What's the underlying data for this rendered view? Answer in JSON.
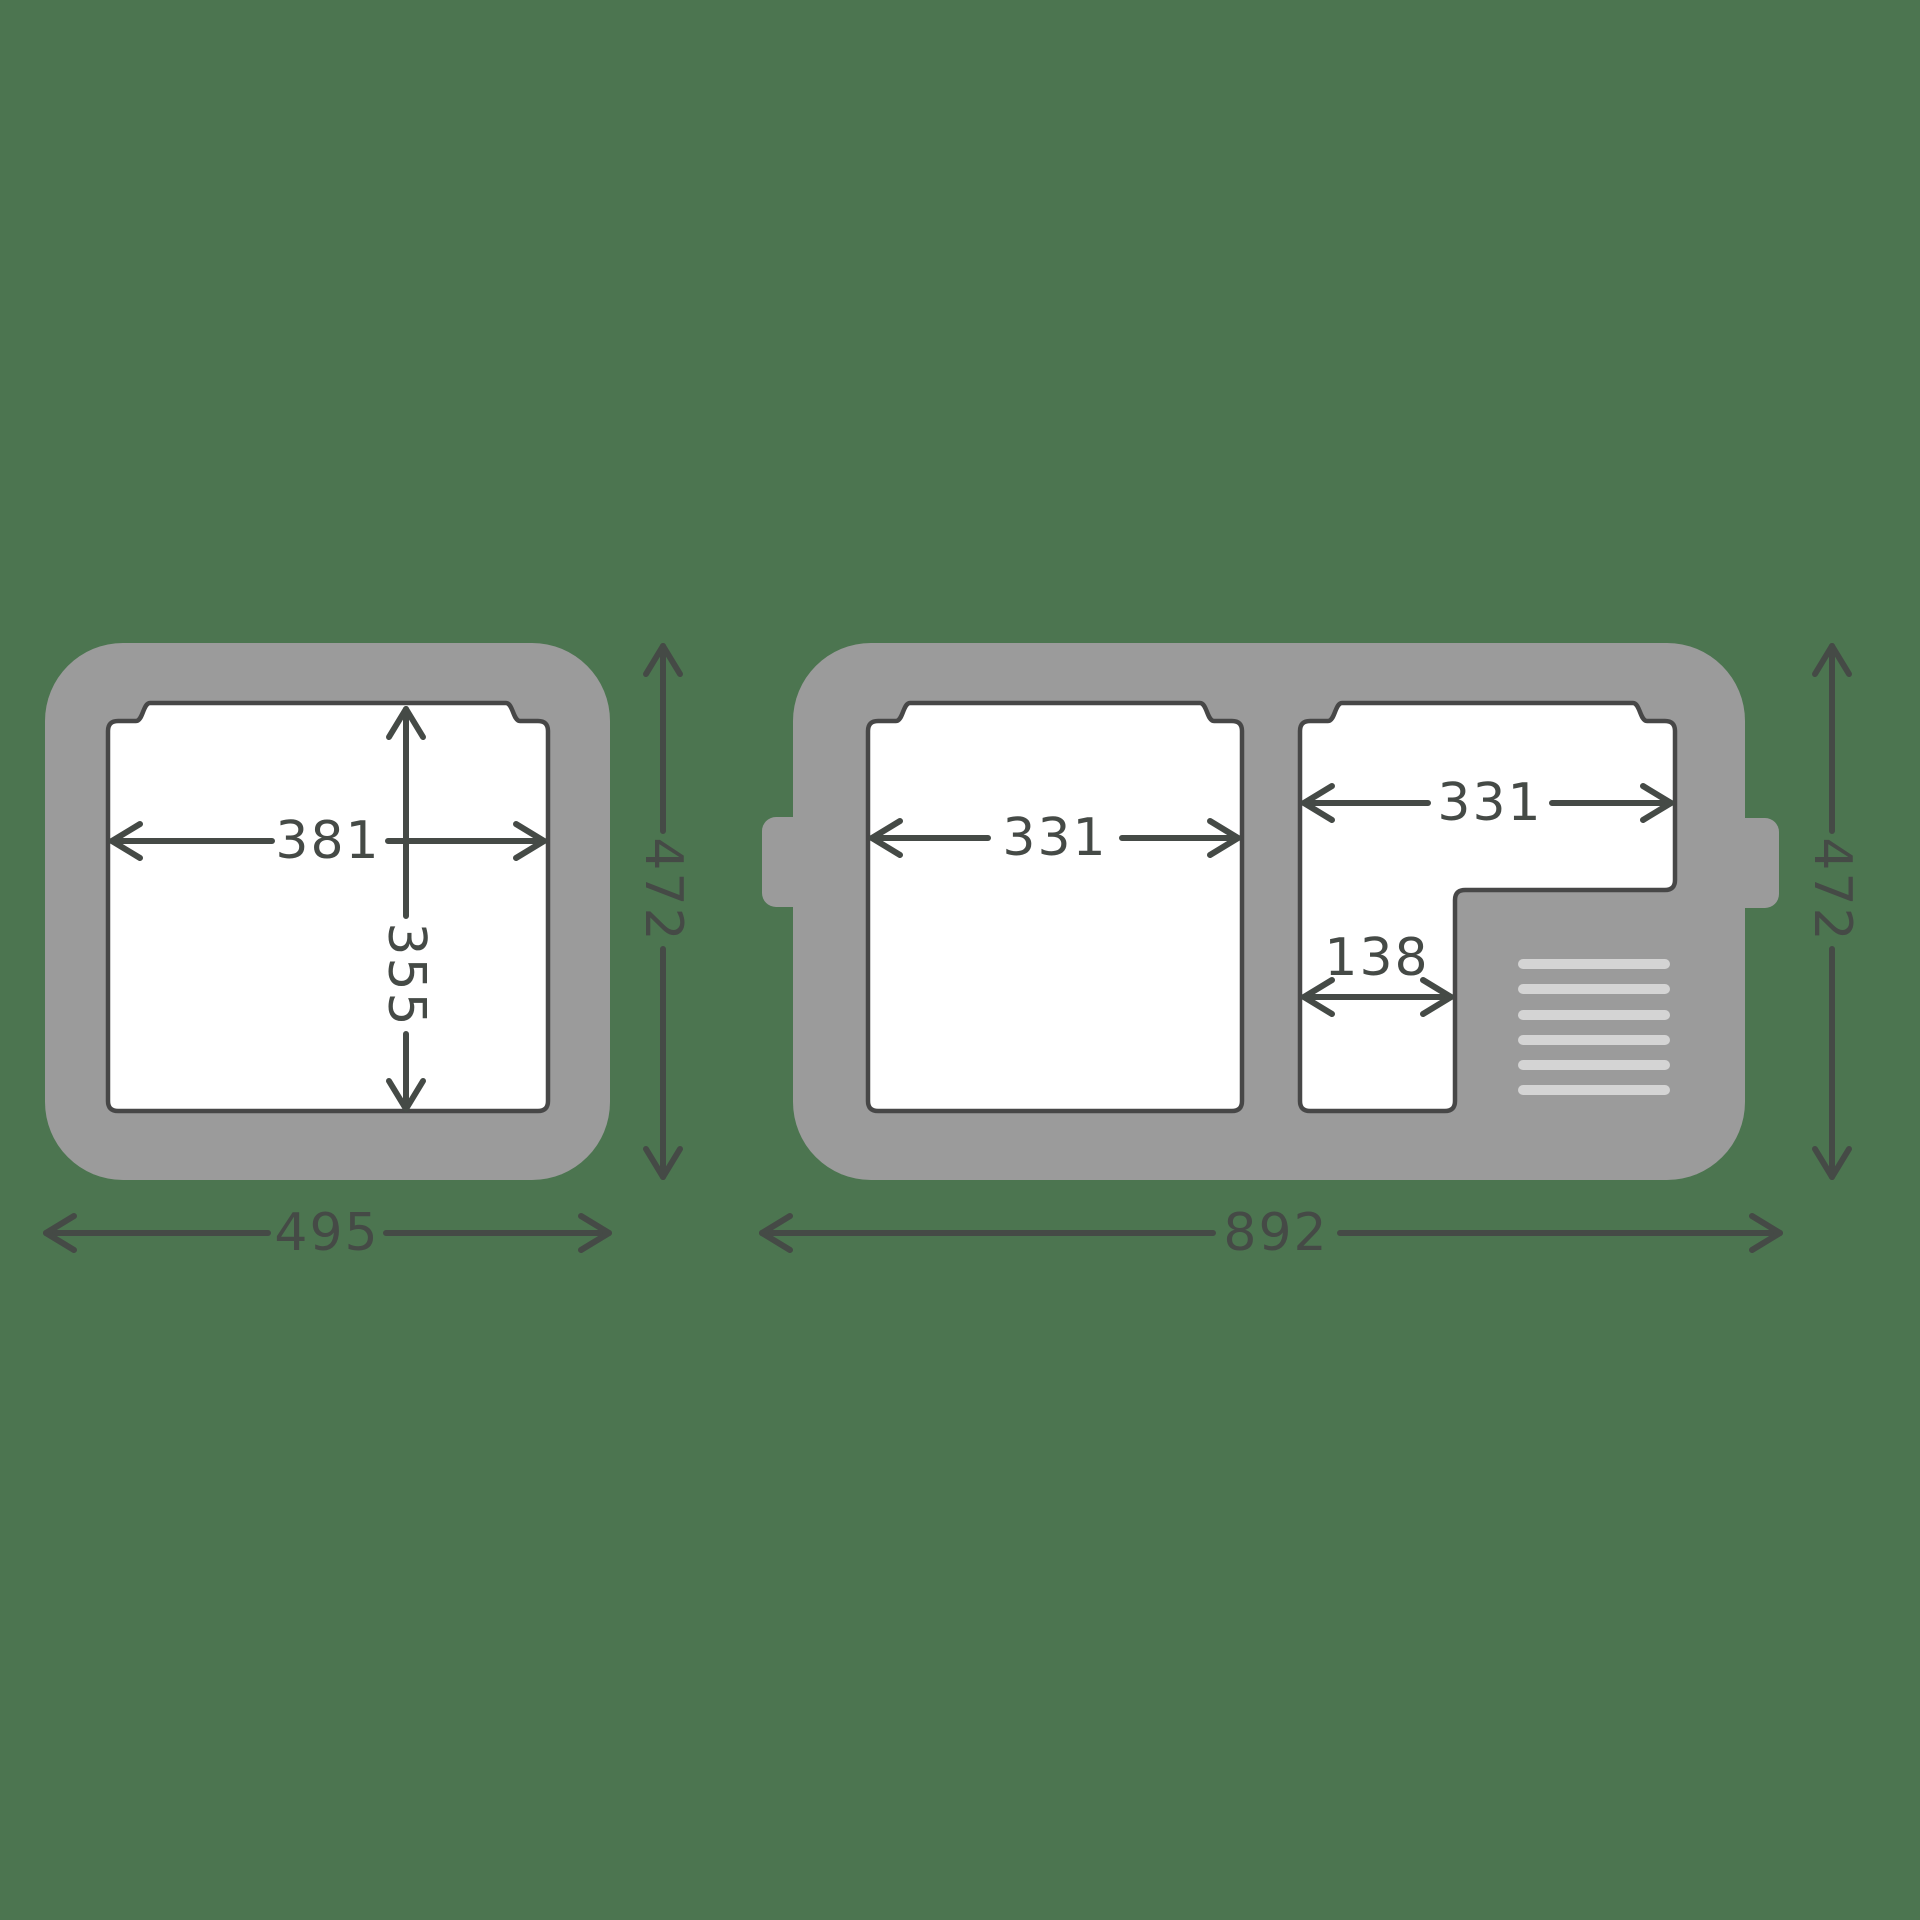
{
  "diagram_title": "cooler-top-view-dimension-diagram",
  "colors": {
    "bg": "#4C7550",
    "box": "#9B9B9B",
    "cavity": "#FFFFFF",
    "outline": "#474747",
    "dim": "#454A46",
    "vent": "#D4D4D4"
  },
  "small_box": {
    "outer_width_label": "495",
    "outer_height_label": "472",
    "cavity_width_label": "381",
    "cavity_depth_label": "355"
  },
  "large_box": {
    "outer_width_label": "892",
    "outer_height_label": "472",
    "left_compartment_width_label": "331",
    "right_compartment_width_label": "331",
    "right_compartment_lower_width_label": "138",
    "vent_slat_count": 6
  }
}
